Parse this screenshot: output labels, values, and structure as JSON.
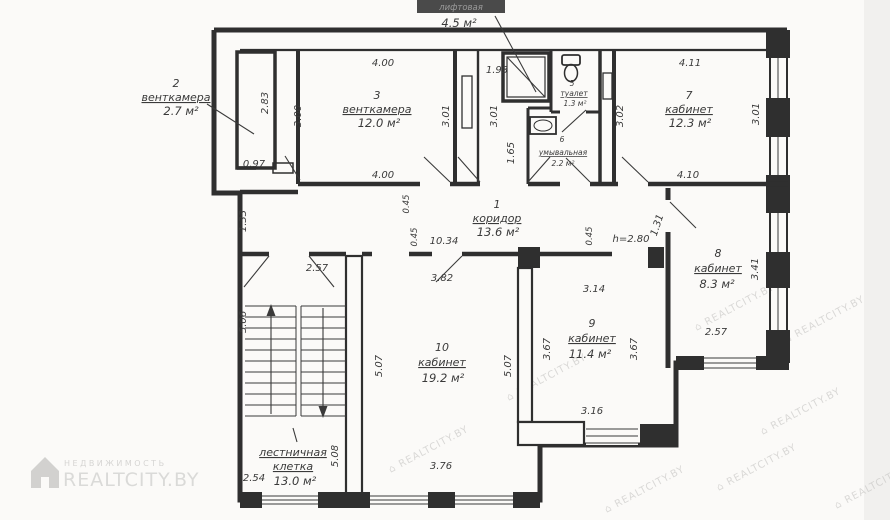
{
  "page": {
    "background": "#fbfaf8",
    "line_color": "#2f2f2f",
    "text_color": "#3a3a3a",
    "watermark_color": "#c3c2c0"
  },
  "rooms": {
    "r1": {
      "number": "1",
      "name": "коридор",
      "area": "13.6 м²"
    },
    "r2": {
      "number": "2",
      "name": "венткамера",
      "area": "2.7 м²"
    },
    "r3": {
      "number": "3",
      "name": "венткамера",
      "area": "12.0 м²"
    },
    "elevator": {
      "label": "лифтовая",
      "area": "4.5 м²"
    },
    "r5": {
      "number": "5",
      "name": "туалет",
      "area": "1.3 м²"
    },
    "r6": {
      "number": "6",
      "name": "умывальная",
      "area": "2.2 м²"
    },
    "r7": {
      "number": "7",
      "name": "кабинет",
      "area": "12.3 м²"
    },
    "r8": {
      "number": "8",
      "name": "кабинет",
      "area": "8.3 м²"
    },
    "r9": {
      "number": "9",
      "name": "кабинет",
      "area": "11.4 м²"
    },
    "r10": {
      "number": "10",
      "name": "кабинет",
      "area": "19.2 м²"
    },
    "stairs": {
      "name_line1": "лестничная",
      "name_line2": "клетка",
      "area": "13.0 м²"
    }
  },
  "dims": {
    "top_400": "4.00",
    "top_193": "1.93",
    "top_411": "4.11",
    "v_283": "2.83",
    "v_300": "3.00",
    "v_301a": "3.01",
    "v_301b": "3.01",
    "v_165": "1.65",
    "v_302": "3.02",
    "v_301r": "3.01",
    "w_097": "0.97",
    "bot_400": "4.00",
    "bot_410": "4.10",
    "v_133": "1.33",
    "v_045a": "0.45",
    "v_045b": "0.45",
    "v_045c": "0.45",
    "corr_1034": "10.34",
    "h_280": "h=2.80",
    "v_131": "1.31",
    "d_257l": "2.57",
    "v_506": "5.06",
    "d_382": "3.82",
    "d_314": "3.14",
    "v_341": "3.41",
    "d_257r": "2.57",
    "v_367a": "3.67",
    "v_367b": "3.67",
    "v_507a": "5.07",
    "v_507b": "5.07",
    "d_316": "3.16",
    "v_508": "5.08",
    "d_376": "3.76",
    "d_254": "2.54"
  },
  "watermark": {
    "stamp": "⌂ REALTCITY.BY"
  },
  "brand": {
    "tagline": "НЕДВИЖИМОСТЬ",
    "name": "REALTCITY.BY"
  }
}
